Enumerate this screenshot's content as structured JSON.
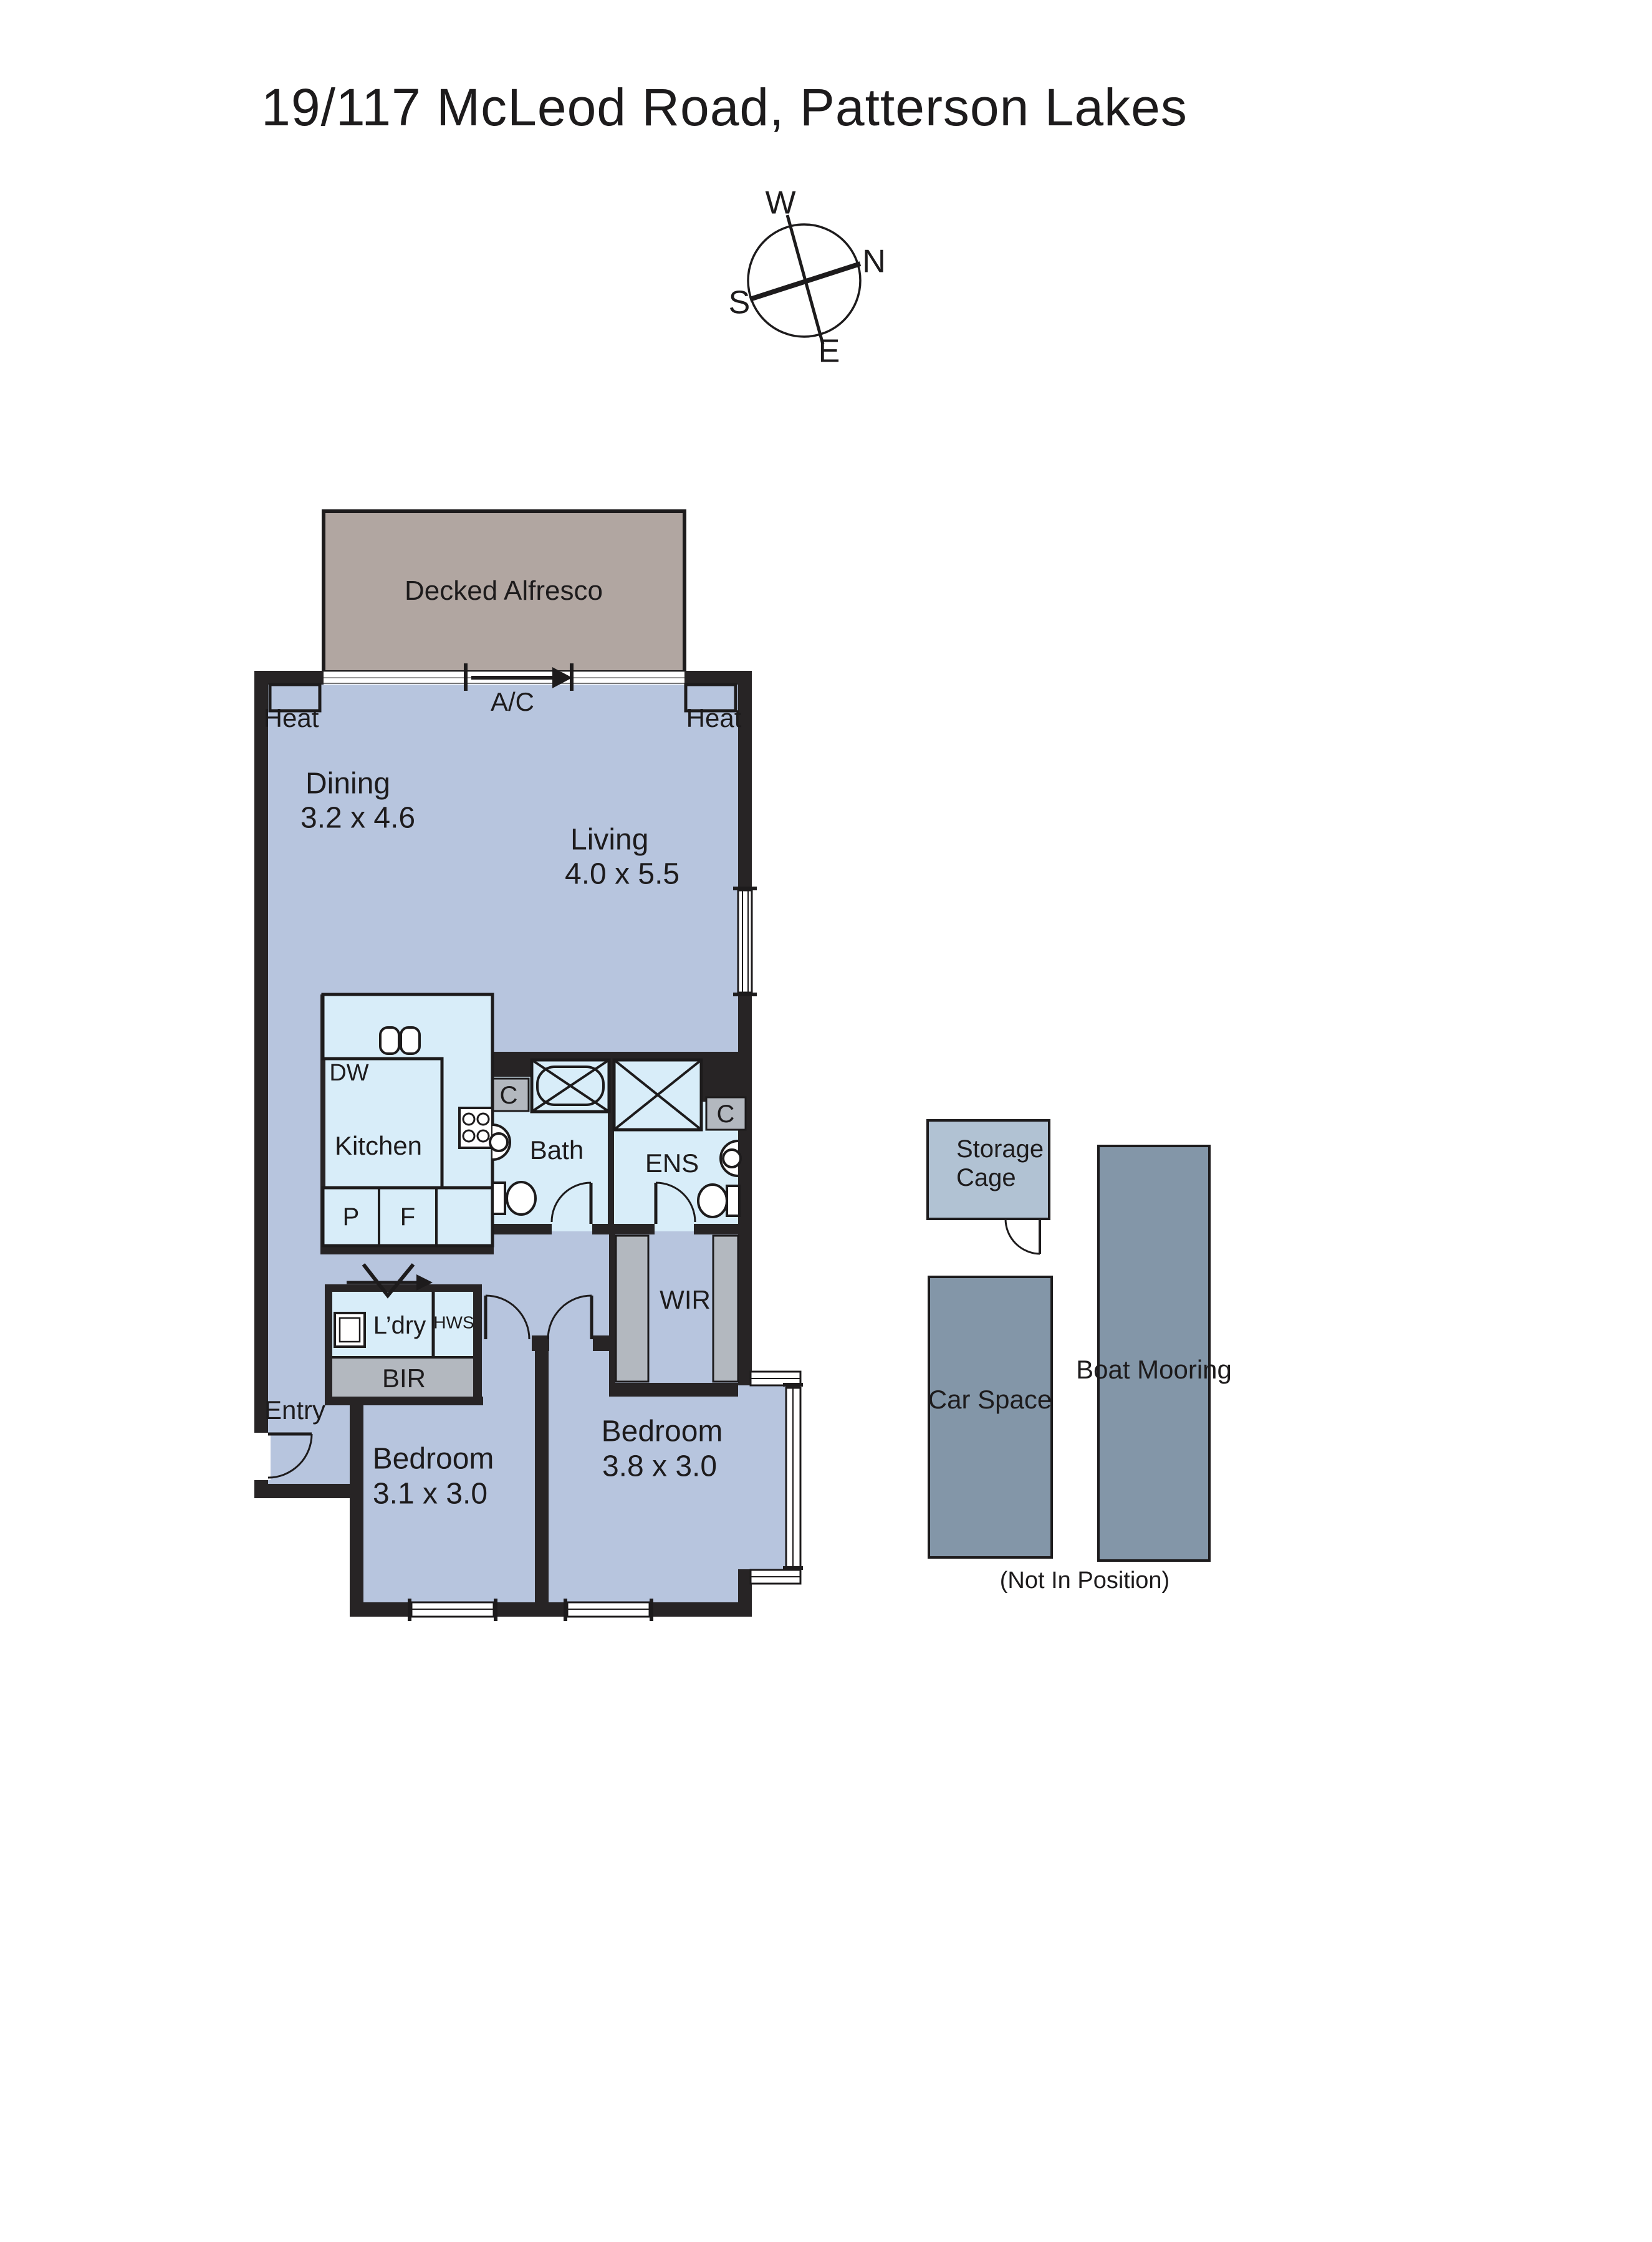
{
  "title": "19/117 McLeod Road, Patterson Lakes",
  "compass": {
    "w": "W",
    "n": "N",
    "s": "S",
    "e": "E"
  },
  "colors": {
    "wall": "#272425",
    "floor": "#b7c5de",
    "wet_floor": "#d8edf9",
    "alfresco": "#b1a6a1",
    "closet_gray": "#b3b8bf",
    "outdoor_dark": "#8396a8",
    "storage_light": "#b1c2d3"
  },
  "plan": {
    "alfresco_label": "Decked Alfresco",
    "ac_label": "A/C",
    "heat_left": "Heat",
    "heat_right": "Heat",
    "dining": {
      "name": "Dining",
      "dims": "3.2 x 4.6"
    },
    "living": {
      "name": "Living",
      "dims": "4.0 x 5.5"
    },
    "kitchen_label": "Kitchen",
    "dw_label": "DW",
    "pantry_label": "P",
    "fridge_label": "F",
    "bath_label": "Bath",
    "ens_label": "ENS",
    "cupboard_bath": "C",
    "cupboard_ens": "C",
    "wir_label": "WIR",
    "laundry_label": "L’dry",
    "hws_label": "HWS",
    "bir_label": "BIR",
    "entry_label": "Entry",
    "bedroom1": {
      "name": "Bedroom",
      "dims": "3.1 x 3.0"
    },
    "bedroom2": {
      "name": "Bedroom",
      "dims": "3.8 x 3.0"
    }
  },
  "outbuildings": {
    "storage_line1": "Storage",
    "storage_line2": "Cage",
    "car_space": "Car Space",
    "boat_mooring": "Boat Mooring",
    "position_note": "(Not In Position)"
  }
}
